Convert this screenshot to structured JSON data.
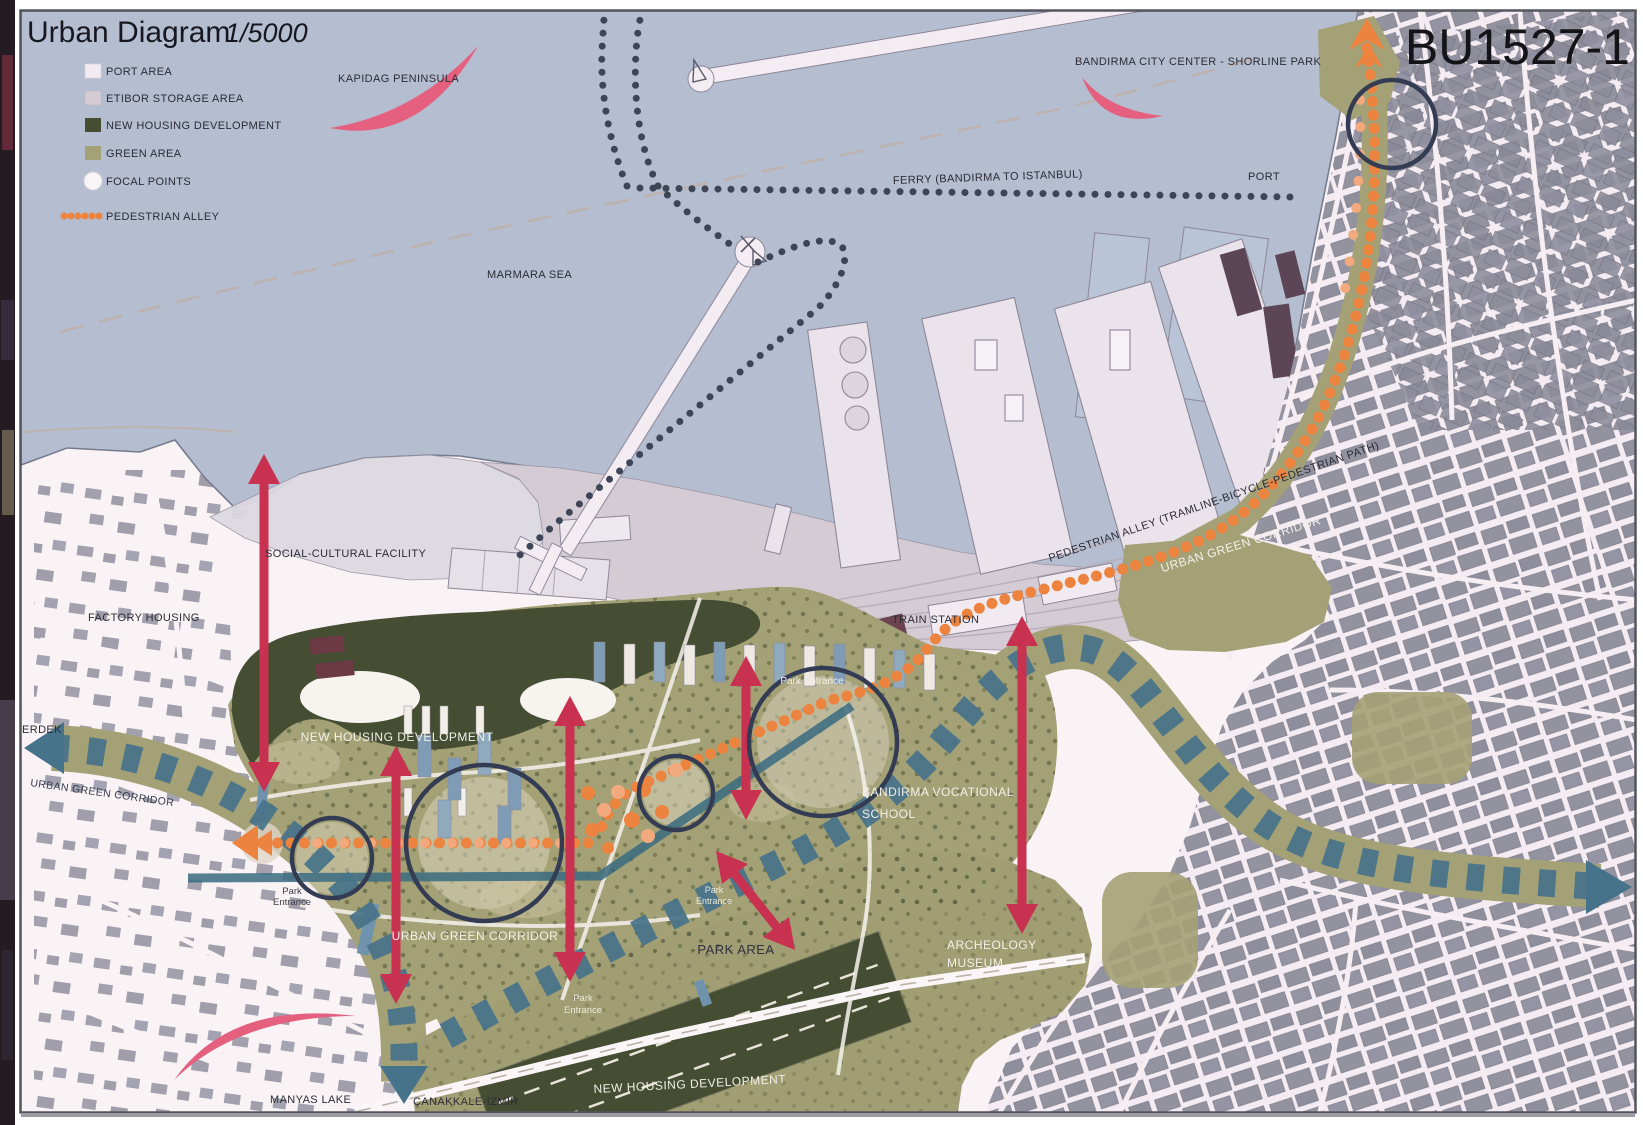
{
  "panel": {
    "title": "Urban Diagram",
    "scale": "1/5000",
    "code": "BU1527-1"
  },
  "legend": {
    "items": [
      {
        "label": "PORT AREA",
        "swatch": "#f2ebf1"
      },
      {
        "label": "ETIBOR STORAGE AREA",
        "swatch": "#d5cbd4"
      },
      {
        "label": "NEW HOUSING DEVELOPMENT",
        "swatch": "#454d33"
      },
      {
        "label": "GREEN AREA",
        "swatch": "#a4a176"
      },
      {
        "label": "FOCAL POINTS",
        "swatch": "#f7f5f6"
      },
      {
        "label": "PEDESTRIAN ALLEY",
        "swatch": "#ec8440"
      }
    ]
  },
  "labels": {
    "kapidag": "KAPIDAG PENINSULA",
    "shoreline_park": "BANDIRMA CITY CENTER - SHORLINE PARK",
    "marmara": "MARMARA SEA",
    "ferry": "FERRY (BANDIRMA TO ISTANBUL)",
    "port": "PORT",
    "social_cultural": "SOCIAL-CULTURAL FACILITY",
    "factory_housing": "FACTORY HOUSING",
    "train_station": "TRAIN STATION",
    "pedestrian_path": "PEDESTRIAN ALLEY (TRAMLINE-BICYCLE-PEDESTRIAN PATH)",
    "ugc_coast": "URBAN GREEN CORRIDOR",
    "ugc_left": "URBAN GREEN CORRIDOR",
    "ugc_park": "URBAN GREEN CORRIDOR",
    "erdek": "ERDEK",
    "nhd_top": "NEW HOUSING DEVELOPMENT",
    "nhd_bottom": "NEW HOUSING DEVELOPMENT",
    "park_area": "PARK AREA",
    "vocational": [
      "BANDIRMA VOCATIONAL",
      "SCHOOL"
    ],
    "museum": [
      "ARCHEOLOGY",
      "MUSEUM"
    ],
    "manyas": "MANYAS LAKE",
    "canakkale": "ÇANAKKALE-İZMİR",
    "park_entrance": {
      "full": "Park Entrance",
      "line1": "Park",
      "line2": "Entrance"
    }
  },
  "colors": {
    "sea": "#b5bdd0",
    "land": "#f9f3f6",
    "port_area": "#f2ebf1",
    "storage_area": "#d5cbd4",
    "green_area": "#a4a176",
    "new_housing": "#454d33",
    "corridor_teal": "#47738a",
    "pedestrian_orange": "#ec8440",
    "focal_navy": "#343c54",
    "arrow_red": "#c93150",
    "accent_pink": "#e4607e",
    "city_building": "#8e8d9b"
  }
}
